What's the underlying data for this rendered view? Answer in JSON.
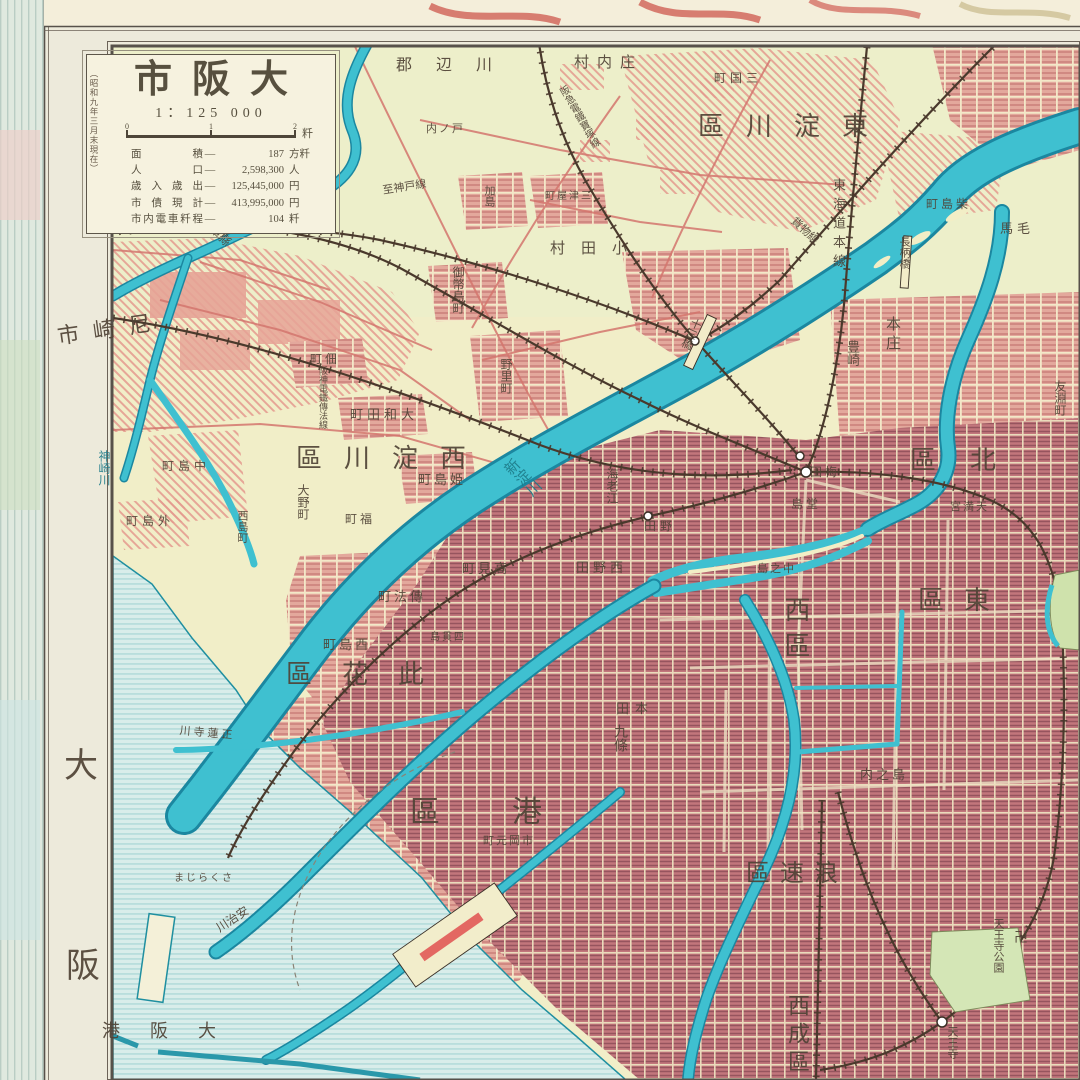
{
  "colors": {
    "paper": "#f1eec8",
    "sea": "#d9edea",
    "sea_line": "#a4d4d4",
    "river": "#3fc0d0",
    "river_edge": "#1b87a0",
    "urban_medium": "#e3a89c",
    "urban_dense": "#c2767c",
    "hatch_red": "#e49a8e",
    "railway": "#4a392c",
    "road_red": "#d4766e",
    "park_green": "#d4e6b6",
    "frame": "#57514a",
    "label_ink": "#504336"
  },
  "title_box": {
    "title": "市阪大",
    "scale_text": "1：125 000",
    "side_note": "（昭和九年三月末現在）",
    "scale_unit": "粁",
    "scale_ticks": [
      "0",
      "1",
      "2"
    ],
    "stats": [
      [
        "面積",
        "187",
        "方粁"
      ],
      [
        "人口",
        "2,598,300",
        "人"
      ],
      [
        "歳入歳出",
        "125,445,000",
        "円"
      ],
      [
        "市債現計",
        "413,995,000",
        "円"
      ],
      [
        "市内電車粁程",
        "104",
        "粁"
      ]
    ]
  },
  "map": {
    "labels": [
      {
        "t": "郡 辺 川",
        "x": 396,
        "y": 58,
        "s": 16,
        "ls": 10
      },
      {
        "t": "村内庄",
        "x": 574,
        "y": 56,
        "s": 15,
        "ls": 8
      },
      {
        "t": "町国三",
        "x": 714,
        "y": 72,
        "s": 12,
        "ls": 4
      },
      {
        "t": "内ノ戸",
        "x": 426,
        "y": 124,
        "s": 11,
        "ls": 2
      },
      {
        "t": "村田小",
        "x": 550,
        "y": 242,
        "s": 15,
        "ls": 16
      },
      {
        "t": "加島",
        "x": 483,
        "y": 185,
        "s": 11,
        "v": true
      },
      {
        "t": "町屋津三",
        "x": 545,
        "y": 192,
        "s": 10,
        "ls": 2
      },
      {
        "t": "至神戸線",
        "x": 382,
        "y": 186,
        "s": 11,
        "rot": -9
      },
      {
        "t": "御幣島町",
        "x": 452,
        "y": 266,
        "s": 12,
        "v": true
      },
      {
        "t": "市崎尼",
        "x": 56,
        "y": 326,
        "s": 22,
        "ls": 14,
        "rot": -8
      },
      {
        "t": "兵庫縣",
        "x": 208,
        "y": 214,
        "s": 12,
        "rot": 46
      },
      {
        "t": "町佃",
        "x": 310,
        "y": 353,
        "s": 12,
        "ls": 3
      },
      {
        "t": "町田和大",
        "x": 350,
        "y": 408,
        "s": 13,
        "ls": 4
      },
      {
        "t": "區川淀西",
        "x": 296,
        "y": 446,
        "s": 26,
        "ls": 22
      },
      {
        "t": "町島姫",
        "x": 418,
        "y": 473,
        "s": 13,
        "ls": 3
      },
      {
        "t": "野里町",
        "x": 500,
        "y": 358,
        "s": 12,
        "v": true
      },
      {
        "t": "大野町",
        "x": 297,
        "y": 484,
        "s": 12,
        "v": true
      },
      {
        "t": "町福",
        "x": 345,
        "y": 513,
        "s": 12,
        "ls": 3
      },
      {
        "t": "神崎川",
        "x": 98,
        "y": 450,
        "s": 12,
        "v": true,
        "c": "#1e7c8a"
      },
      {
        "t": "町島中",
        "x": 162,
        "y": 460,
        "s": 12,
        "ls": 4
      },
      {
        "t": "町島外",
        "x": 126,
        "y": 515,
        "s": 12,
        "ls": 4
      },
      {
        "t": "西島町",
        "x": 236,
        "y": 510,
        "s": 11,
        "v": true
      },
      {
        "t": "阪神電鐵傳法線",
        "x": 318,
        "y": 366,
        "s": 9,
        "v": true
      },
      {
        "t": "新淀川",
        "x": 500,
        "y": 468,
        "s": 15,
        "v": true,
        "rot": -45,
        "c": "#1e7c8a"
      },
      {
        "t": "町見高",
        "x": 462,
        "y": 562,
        "s": 13,
        "ls": 3
      },
      {
        "t": "町法傳",
        "x": 378,
        "y": 590,
        "s": 13,
        "ls": 3
      },
      {
        "t": "町島酉",
        "x": 323,
        "y": 638,
        "s": 13,
        "ls": 3
      },
      {
        "t": "島貫四",
        "x": 430,
        "y": 633,
        "s": 10,
        "ls": 2
      },
      {
        "t": "區花此",
        "x": 286,
        "y": 662,
        "s": 26,
        "ls": 30
      },
      {
        "t": "川寺蓮正",
        "x": 180,
        "y": 726,
        "s": 11,
        "ls": 3,
        "rot": 5
      },
      {
        "t": "まじらくさ",
        "x": 174,
        "y": 874,
        "s": 10,
        "ls": 2
      },
      {
        "t": "川治安",
        "x": 214,
        "y": 924,
        "s": 12,
        "rot": -33
      },
      {
        "t": "港阪大",
        "x": 102,
        "y": 1022,
        "s": 18,
        "ls": 30
      },
      {
        "t": "大",
        "x": 64,
        "y": 750,
        "s": 34
      },
      {
        "t": "阪",
        "x": 66,
        "y": 950,
        "s": 34
      },
      {
        "t": "區港",
        "x": 410,
        "y": 798,
        "s": 30,
        "ls": 72
      },
      {
        "t": "町元岡市",
        "x": 483,
        "y": 836,
        "s": 11,
        "ls": 2
      },
      {
        "t": "田本",
        "x": 616,
        "y": 702,
        "s": 13,
        "ls": 6
      },
      {
        "t": "九條",
        "x": 612,
        "y": 724,
        "s": 14,
        "v": true
      },
      {
        "t": "田野",
        "x": 644,
        "y": 520,
        "s": 12,
        "ls": 4
      },
      {
        "t": "海老江",
        "x": 606,
        "y": 468,
        "s": 12,
        "v": true
      },
      {
        "t": "田野西",
        "x": 576,
        "y": 561,
        "s": 13,
        "ls": 4
      },
      {
        "t": "島堂",
        "x": 791,
        "y": 498,
        "s": 12,
        "ls": 3
      },
      {
        "t": "島之中",
        "x": 757,
        "y": 564,
        "s": 11,
        "ls": 2
      },
      {
        "t": "田梅",
        "x": 810,
        "y": 466,
        "s": 12,
        "ls": 3
      },
      {
        "t": "宮満天",
        "x": 950,
        "y": 502,
        "s": 11,
        "ls": 2
      },
      {
        "t": "區北",
        "x": 910,
        "y": 448,
        "s": 26,
        "ls": 34
      },
      {
        "t": "區東",
        "x": 918,
        "y": 588,
        "s": 26,
        "ls": 20
      },
      {
        "t": "西區",
        "x": 782,
        "y": 596,
        "s": 26,
        "v": true,
        "ls": 10
      },
      {
        "t": "本庄",
        "x": 884,
        "y": 316,
        "s": 15,
        "v": true,
        "ls": 4
      },
      {
        "t": "豊崎",
        "x": 846,
        "y": 340,
        "s": 13,
        "v": true
      },
      {
        "t": "十三橋",
        "x": 692,
        "y": 316,
        "s": 11,
        "v": true,
        "rot": 24
      },
      {
        "t": "長柄橋",
        "x": 898,
        "y": 236,
        "s": 11,
        "v": true
      },
      {
        "t": "馬毛",
        "x": 1000,
        "y": 222,
        "s": 13,
        "ls": 4
      },
      {
        "t": "町島柴",
        "x": 926,
        "y": 198,
        "s": 12,
        "ls": 3
      },
      {
        "t": "友淵町",
        "x": 1054,
        "y": 380,
        "s": 12,
        "v": true
      },
      {
        "t": "東海道本線",
        "x": 832,
        "y": 178,
        "s": 13,
        "v": true,
        "ls": 6
      },
      {
        "t": "貨物線",
        "x": 796,
        "y": 216,
        "s": 11,
        "rot": 43
      },
      {
        "t": "阪急電鐵寶塚線",
        "x": 556,
        "y": 90,
        "s": 10,
        "v": true,
        "rot": -30
      },
      {
        "t": "區速浪",
        "x": 746,
        "y": 862,
        "s": 24,
        "ls": 10
      },
      {
        "t": "内之島",
        "x": 860,
        "y": 768,
        "s": 13,
        "ls": 3
      },
      {
        "t": "西成區",
        "x": 786,
        "y": 994,
        "s": 22,
        "v": true,
        "ls": 6
      },
      {
        "t": "天王寺公園",
        "x": 992,
        "y": 918,
        "s": 11,
        "v": true
      },
      {
        "t": "卍",
        "x": 1014,
        "y": 932,
        "s": 14
      },
      {
        "t": "天王寺",
        "x": 946,
        "y": 1026,
        "s": 11,
        "v": true
      },
      {
        "t": "區川淀東",
        "x": 698,
        "y": 114,
        "s": 26,
        "ls": 22
      }
    ]
  }
}
